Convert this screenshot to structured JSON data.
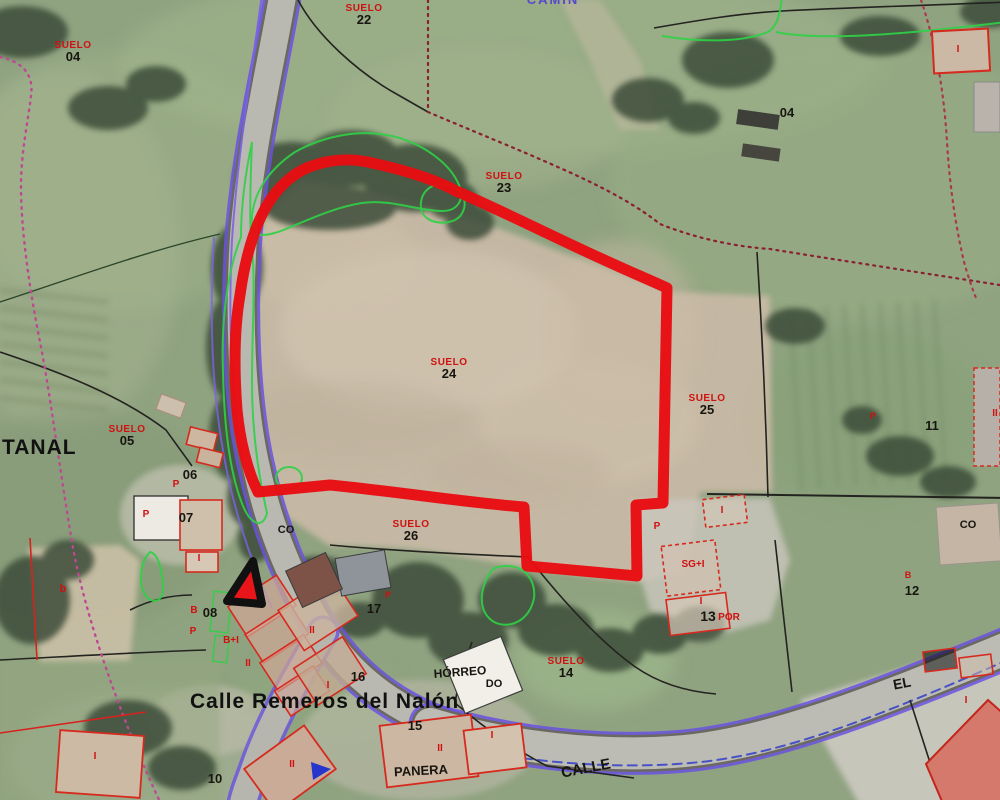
{
  "map": {
    "type": "cadastral-aerial-map",
    "colors": {
      "highlight_red": "#e80d12",
      "building_red": "#d62a1e",
      "boundary_pink": "#bb4a92",
      "boundary_dark_red": "#8a2030",
      "road_casing_purple": "#6a52e0",
      "green_outline": "#2fd146",
      "label_red": "#cf1110",
      "label_black": "#17150f",
      "label_blue": "#5548cf",
      "terrain_green": "#90a381",
      "terrain_tan": "#c8b9a5",
      "road_grey": "#b7b7b1"
    },
    "suelo_labels": [
      {
        "word": "SUELO",
        "num": "04",
        "x": 73,
        "y": 41
      },
      {
        "word": "SUELO",
        "num": "22",
        "x": 364,
        "y": 4
      },
      {
        "word": "SUELO",
        "num": "23",
        "x": 504,
        "y": 172
      },
      {
        "word": "SUELO",
        "num": "24",
        "x": 449,
        "y": 358
      },
      {
        "word": "SUELO",
        "num": "25",
        "x": 707,
        "y": 394
      },
      {
        "word": "SUELO",
        "num": "26",
        "x": 411,
        "y": 520
      },
      {
        "word": "SUELO",
        "num": "05",
        "x": 127,
        "y": 425
      },
      {
        "word": "SUELO",
        "num": "14",
        "x": 566,
        "y": 657
      }
    ],
    "labels": [
      {
        "text": "TANAL",
        "x": 2,
        "y": 437,
        "kind": "edge",
        "name": "street-name-tanal"
      },
      {
        "text": "Calle Remeros del Nalón",
        "x": 190,
        "y": 691,
        "kind": "edge",
        "name": "street-name-remeros"
      },
      {
        "text": "CAMIN",
        "x": 553,
        "y": -7,
        "kind": "blue",
        "name": "street-name-camin"
      },
      {
        "text": "04",
        "x": 787,
        "y": 106,
        "kind": "num",
        "name": "parcel-number"
      },
      {
        "text": "06",
        "x": 190,
        "y": 468,
        "kind": "num",
        "name": "parcel-number"
      },
      {
        "text": "07",
        "x": 186,
        "y": 511,
        "kind": "num",
        "name": "parcel-number"
      },
      {
        "text": "08",
        "x": 210,
        "y": 606,
        "kind": "num",
        "name": "parcel-number"
      },
      {
        "text": "10",
        "x": 215,
        "y": 772,
        "kind": "num",
        "name": "parcel-number"
      },
      {
        "text": "11",
        "x": 932,
        "y": 419,
        "kind": "num",
        "name": "parcel-number"
      },
      {
        "text": "12",
        "x": 912,
        "y": 584,
        "kind": "num",
        "name": "parcel-number"
      },
      {
        "text": "13",
        "x": 708,
        "y": 609,
        "kind": "num",
        "fs": 14,
        "name": "parcel-number"
      },
      {
        "text": "15",
        "x": 415,
        "y": 719,
        "kind": "num",
        "name": "parcel-number"
      },
      {
        "text": "16",
        "x": 358,
        "y": 670,
        "kind": "num",
        "name": "parcel-number"
      },
      {
        "text": "17",
        "x": 374,
        "y": 602,
        "kind": "num",
        "name": "parcel-number"
      },
      {
        "text": "HÓRREO",
        "x": 460,
        "y": 666,
        "kind": "word",
        "fs": 12,
        "rot": -4,
        "name": "building-label-horreo"
      },
      {
        "text": "DO",
        "x": 494,
        "y": 679,
        "kind": "word",
        "fs": 11,
        "name": "code-label"
      },
      {
        "text": "CO",
        "x": 286,
        "y": 525,
        "kind": "word",
        "fs": 11,
        "name": "code-label"
      },
      {
        "text": "CO",
        "x": 968,
        "y": 520,
        "kind": "word",
        "fs": 11,
        "name": "code-label"
      },
      {
        "text": "PANERA",
        "x": 421,
        "y": 764,
        "kind": "word",
        "fs": 13,
        "rot": -3,
        "name": "building-label-panera"
      },
      {
        "text": "CALLE",
        "x": 586,
        "y": 761,
        "kind": "word",
        "fs": 15,
        "rot": -11,
        "name": "street-name-calle"
      },
      {
        "text": "EL",
        "x": 902,
        "y": 676,
        "kind": "word",
        "fs": 14,
        "rot": -11,
        "name": "street-name-el"
      },
      {
        "text": "P",
        "x": 146,
        "y": 510,
        "kind": "red",
        "name": "building-code"
      },
      {
        "text": "P",
        "x": 176,
        "y": 480,
        "kind": "red",
        "name": "building-code"
      },
      {
        "text": "I",
        "x": 199,
        "y": 554,
        "kind": "red",
        "name": "building-code"
      },
      {
        "text": "P",
        "x": 193,
        "y": 627,
        "kind": "red",
        "name": "building-code"
      },
      {
        "text": "B",
        "x": 194,
        "y": 606,
        "kind": "red",
        "name": "building-code"
      },
      {
        "text": "B+I",
        "x": 231,
        "y": 636,
        "kind": "red",
        "name": "building-code"
      },
      {
        "text": "II",
        "x": 248,
        "y": 659,
        "kind": "red",
        "name": "building-code"
      },
      {
        "text": "II",
        "x": 312,
        "y": 626,
        "kind": "red",
        "name": "building-code"
      },
      {
        "text": "I",
        "x": 328,
        "y": 681,
        "kind": "red",
        "name": "building-code"
      },
      {
        "text": "P",
        "x": 388,
        "y": 591,
        "kind": "redsm",
        "name": "building-code"
      },
      {
        "text": "P",
        "x": 657,
        "y": 522,
        "kind": "red",
        "name": "building-code"
      },
      {
        "text": "I",
        "x": 722,
        "y": 506,
        "kind": "red",
        "name": "building-code"
      },
      {
        "text": "SG+I",
        "x": 693,
        "y": 560,
        "kind": "red",
        "name": "building-code"
      },
      {
        "text": "I",
        "x": 701,
        "y": 597,
        "kind": "red",
        "name": "building-code"
      },
      {
        "text": "POR",
        "x": 729,
        "y": 613,
        "kind": "red",
        "name": "building-code"
      },
      {
        "text": "B",
        "x": 908,
        "y": 571,
        "kind": "redsm",
        "name": "building-code"
      },
      {
        "text": "II",
        "x": 995,
        "y": 409,
        "kind": "red",
        "name": "building-code"
      },
      {
        "text": "I",
        "x": 958,
        "y": 45,
        "kind": "red",
        "name": "building-code"
      },
      {
        "text": "I",
        "x": 966,
        "y": 696,
        "kind": "red",
        "name": "building-code"
      },
      {
        "text": "b",
        "x": 63,
        "y": 584,
        "kind": "red",
        "fs": 11,
        "name": "parcel-code"
      },
      {
        "text": "P",
        "x": 873,
        "y": 412,
        "kind": "redsm",
        "name": "building-code"
      },
      {
        "text": "II",
        "x": 440,
        "y": 744,
        "kind": "red",
        "name": "building-code"
      },
      {
        "text": "I",
        "x": 492,
        "y": 731,
        "kind": "red",
        "name": "building-code"
      },
      {
        "text": "II",
        "x": 292,
        "y": 760,
        "kind": "red",
        "name": "building-code"
      },
      {
        "text": "I",
        "x": 95,
        "y": 752,
        "kind": "red",
        "name": "building-code"
      }
    ]
  }
}
